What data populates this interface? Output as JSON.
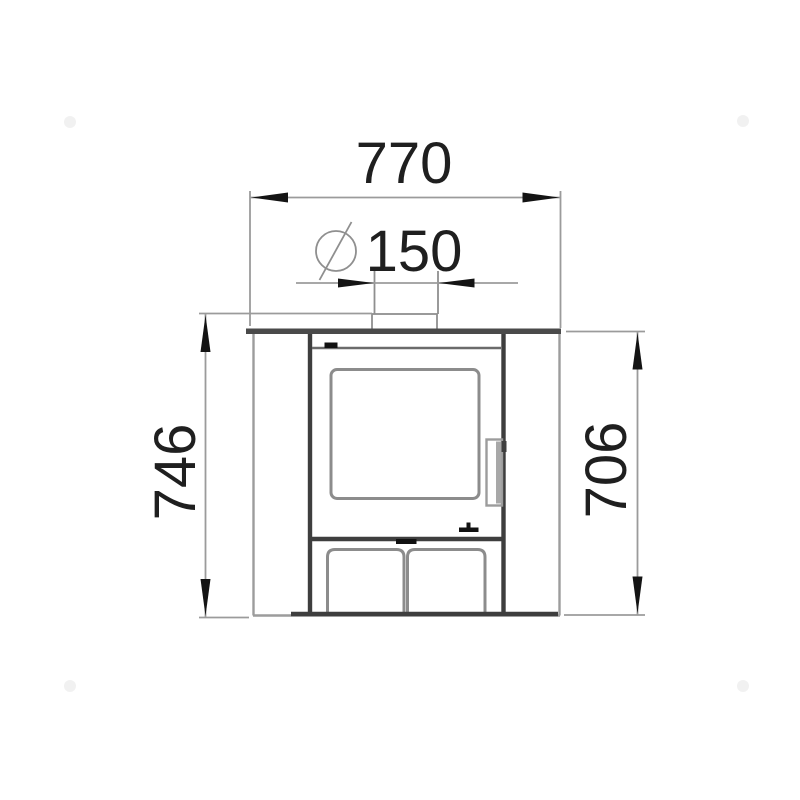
{
  "drawing": {
    "title": "Wood stove front elevation dimension drawing",
    "units": "mm",
    "dimensions": {
      "overall_width": {
        "value": "770",
        "orientation": "horizontal",
        "location": "top"
      },
      "flue_diameter": {
        "symbol": "Ø",
        "value": "150",
        "orientation": "horizontal",
        "location": "top-center"
      },
      "total_height": {
        "value": "746",
        "orientation": "vertical",
        "location": "left"
      },
      "body_height": {
        "value": "706",
        "orientation": "vertical",
        "location": "right"
      }
    }
  },
  "palette": {
    "background": "#ffffff",
    "text": "#1f1f1f",
    "dimension_line": "#9b9b9b",
    "arrow": "#141414",
    "outline_dark": "#3e3e3e",
    "outline_medium": "#6b6b6b",
    "outline_light": "#9c9c9c",
    "frame_gray": "#8c8c8c",
    "detail_black": "#111111"
  }
}
